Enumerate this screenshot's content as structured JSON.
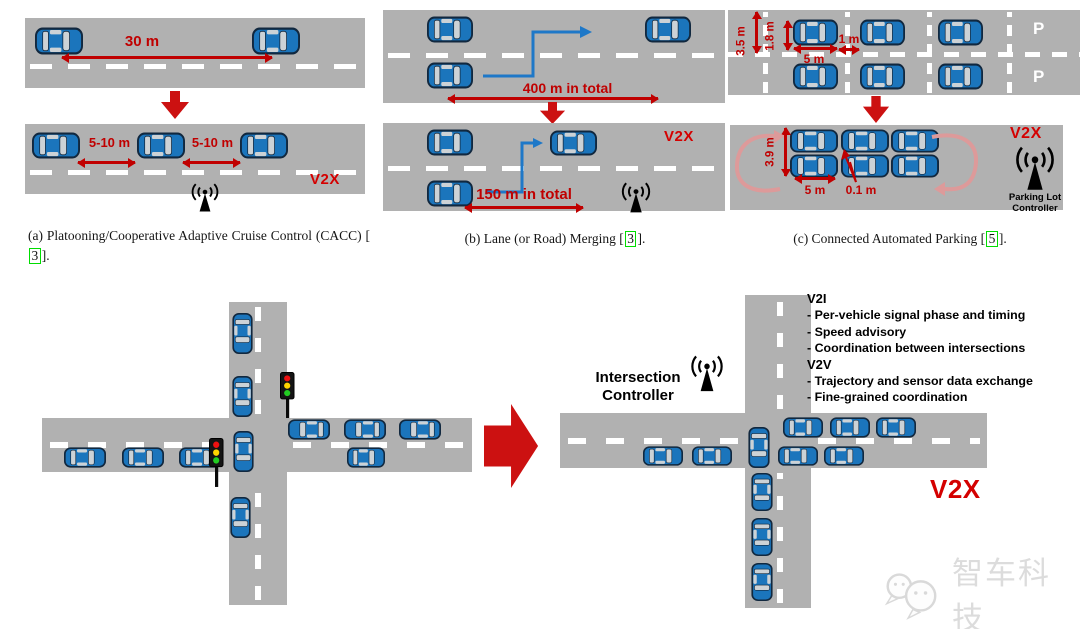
{
  "panel_a": {
    "distance_label": "30 m",
    "gap_label_1": "5-10 m",
    "gap_label_2": "5-10 m",
    "v2x_label": "V2X",
    "caption_prefix": "(a) Platooning/Cooperative Adaptive Cruise Control (CACC) [",
    "caption_cite": "3",
    "caption_suffix": "]."
  },
  "panel_b": {
    "distance_before": "400 m in total",
    "distance_after": "150 m in total",
    "v2x_label": "V2X",
    "caption_prefix": "(b) Lane (or Road) Merging [",
    "caption_cite": "3",
    "caption_suffix": "]."
  },
  "panel_c": {
    "lane_width": "3.5 m",
    "car_width": "1.8 m",
    "gap_before": "1 m",
    "car_length_before": "5 m",
    "parking_sign_top": "P",
    "parking_sign_bottom": "P",
    "row_width_after": "3.9 m",
    "car_length_after": "5 m",
    "gap_after": "0.1 m",
    "v2x_label": "V2X",
    "controller_label": "Parking Lot\nController",
    "caption_prefix": "(c) Connected Automated Parking [",
    "caption_cite": "5",
    "caption_suffix": "]."
  },
  "intersection": {
    "controller_label": "Intersection\nController",
    "v2i_header": "V2I",
    "v2i_items": [
      "- Per-vehicle signal phase and timing",
      "- Speed advisory",
      "- Coordination between intersections"
    ],
    "v2v_header": "V2V",
    "v2v_items": [
      "- Trajectory and sensor data exchange",
      "- Fine-grained coordination"
    ],
    "v2x_label": "V2X"
  },
  "watermark": {
    "text": "智车科技"
  },
  "colors": {
    "road_gray": "#b1b1b1",
    "car_blue": "#1b75bc",
    "measure_red": "#c00000",
    "big_arrow_red": "#cc1111",
    "v2x_red": "#d40000",
    "merge_arrow_blue": "#1e78c8",
    "cite_green": "#00dd00",
    "traffic_red": "#ee1111",
    "traffic_yellow": "#ffd500",
    "traffic_green": "#22cc22"
  }
}
